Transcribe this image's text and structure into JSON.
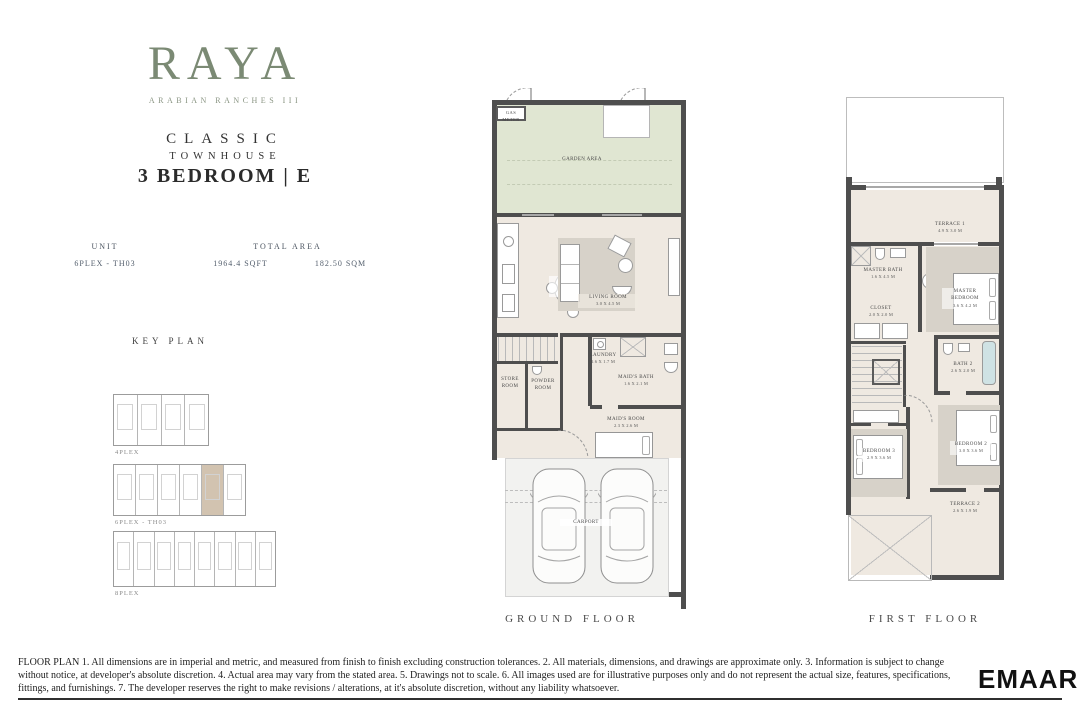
{
  "brand": {
    "logo": "RAYA",
    "subtitle": "ARABIAN RANCHES III"
  },
  "title": {
    "collection": "CLASSIC",
    "type": "TOWNHOUSE",
    "unit": "3 BEDROOM | E"
  },
  "specs": {
    "unit_label": "UNIT",
    "unit_value": "6PLEX - TH03",
    "area_label": "TOTAL AREA",
    "area_imperial": "1964.4 SQFT",
    "area_metric": "182.50 SQM"
  },
  "key_plan": {
    "title": "KEY PLAN",
    "blocks": [
      {
        "label": "4PLEX",
        "units": 4,
        "highlight": -1
      },
      {
        "label": "6PLEX - TH03",
        "units": 6,
        "highlight": 4
      },
      {
        "label": "8PLEX",
        "units": 8,
        "highlight": -1
      }
    ]
  },
  "ground": {
    "label": "GROUND FLOOR",
    "rooms": {
      "gas_meter": "GAS METER",
      "garden": "GARDEN AREA",
      "kitchen_dining": {
        "name": "KITCHEN / DINING",
        "dims": "2.9 X 5.6 M"
      },
      "living": {
        "name": "LIVING ROOM",
        "dims": "3.0 X 4.5 M"
      },
      "store": {
        "name": "STORE ROOM"
      },
      "powder": {
        "name": "POWDER ROOM"
      },
      "laundry": {
        "name": "LAUNDRY",
        "dims": "1.6 X 1.7 M"
      },
      "maids_bath": {
        "name": "MAID'S BATH",
        "dims": "1.6 X 2.1 M"
      },
      "maids_room": {
        "name": "MAID'S ROOM",
        "dims": "2.3 X 2.6 M"
      },
      "carport": {
        "name": "CARPORT"
      }
    }
  },
  "first": {
    "label": "FIRST FLOOR",
    "rooms": {
      "terrace1": {
        "name": "TERRACE 1",
        "dims": "4.9 X 3.0 M"
      },
      "master_bath": {
        "name": "MASTER BATH",
        "dims": "1.6 X 4.5 M"
      },
      "closet": {
        "name": "CLOSET",
        "dims": "2.0 X 2.0 M"
      },
      "master_bedroom": {
        "name": "MASTER BEDROOM",
        "dims": "3.6 X 4.2 M"
      },
      "bath2": {
        "name": "BATH 2",
        "dims": "2.6 X 2.0 M"
      },
      "bedroom2": {
        "name": "BEDROOM 2",
        "dims": "3.0 X 3.6 M"
      },
      "bedroom3": {
        "name": "BEDROOM 3",
        "dims": "2.9 X 3.6 M"
      },
      "terrace2": {
        "name": "TERRACE 2",
        "dims": "2.6 X 1.9 M"
      }
    }
  },
  "footer": {
    "disclaimer": "FLOOR PLAN 1. All dimensions are in imperial and metric, and measured from finish to finish excluding construction tolerances. 2. All materials, dimensions, and drawings are approximate only. 3. Information is subject to change without notice, at developer's absolute discretion. 4. Actual area may vary from the stated area. 5. Drawings not to scale. 6. All images used are for illustrative purposes only and do not represent the actual size, features, specifications, fittings, and furnishings. 7. The developer reserves the right to make revisions / alterations, at it's absolute discretion, without any liability whatsoever.",
    "developer": "EMAAR"
  },
  "colors": {
    "logo_green": "#7b8a74",
    "wall": "#4e4e4e",
    "garden": "#e0e6d2",
    "floor": "#efe9e1",
    "rug": "#d7d2c9",
    "highlight": "#d2c3b0"
  }
}
